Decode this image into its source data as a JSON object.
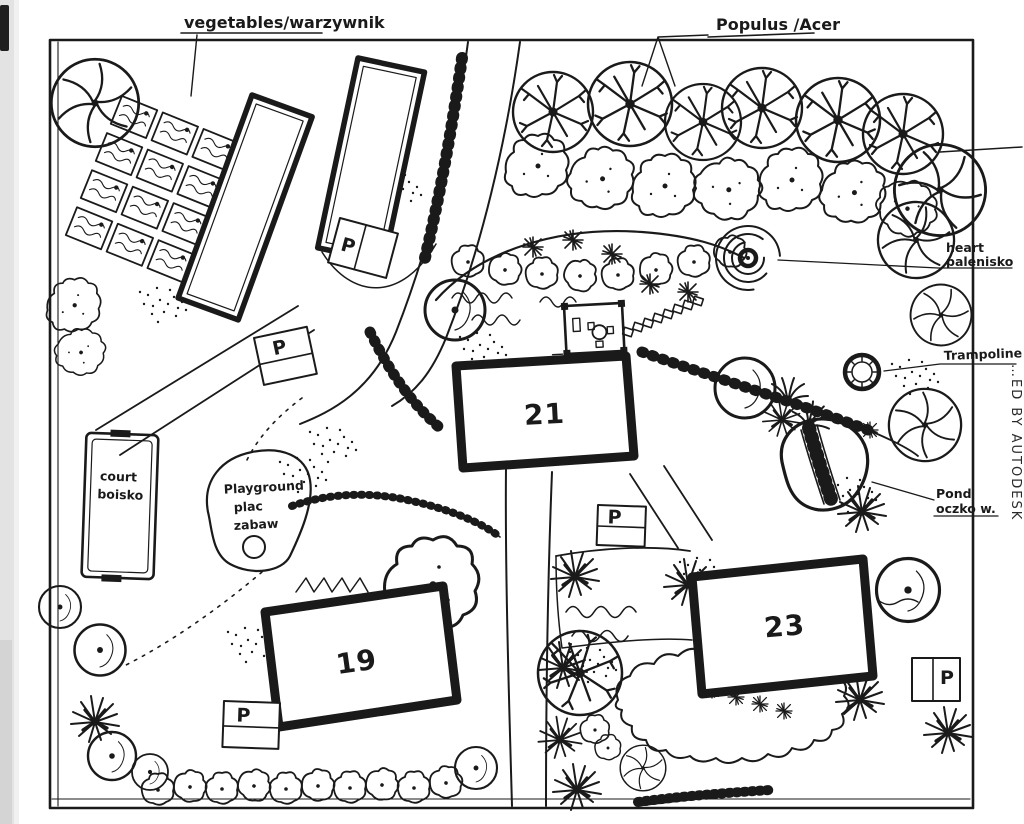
{
  "plan": {
    "labels": {
      "vegetables": "vegetables/warzywnik",
      "populus": "Populus /Acer",
      "heart1": "heart",
      "heart2": "palenisko",
      "trampoline": "Trampoline",
      "pond1": "Pond",
      "pond2": "oczko w.",
      "court1": "court",
      "court2": "boisko",
      "playground1": "Playground",
      "playground2": "plac",
      "playground3": "zabaw"
    },
    "buildings": {
      "b19": "19",
      "b21": "21",
      "b23": "23"
    },
    "parking": "P",
    "watermark": "…ED BY AUTODESK",
    "colors": {
      "ink": "#1a1a1a",
      "paper": "#ffffff"
    }
  }
}
